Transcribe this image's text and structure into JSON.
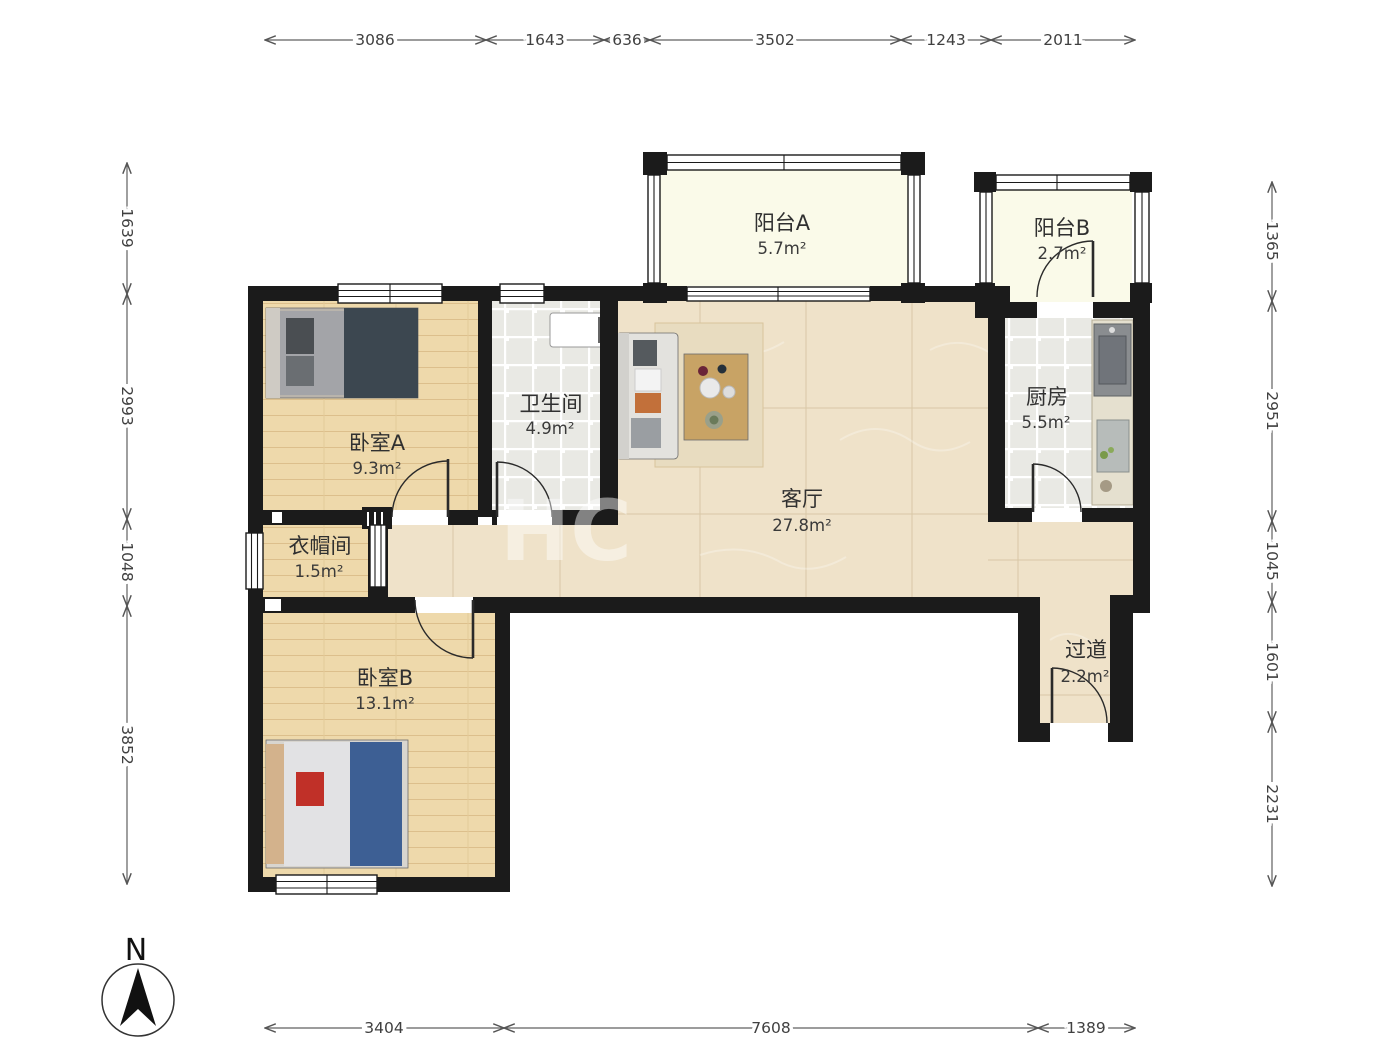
{
  "rooms": [
    {
      "id": "balcony-a",
      "name": "阳台A",
      "area": "5.7m²"
    },
    {
      "id": "balcony-b",
      "name": "阳台B",
      "area": "2.7m²"
    },
    {
      "id": "bedroom-a",
      "name": "卧室A",
      "area": "9.3m²"
    },
    {
      "id": "bathroom",
      "name": "卫生间",
      "area": "4.9m²"
    },
    {
      "id": "kitchen",
      "name": "厨房",
      "area": "5.5m²"
    },
    {
      "id": "living-room",
      "name": "客厅",
      "area": "27.8m²"
    },
    {
      "id": "cloakroom",
      "name": "衣帽间",
      "area": "1.5m²"
    },
    {
      "id": "bedroom-b",
      "name": "卧室B",
      "area": "13.1m²"
    },
    {
      "id": "hallway",
      "name": "过道",
      "area": "2.2m²"
    }
  ],
  "dimensions": {
    "top": [
      "3086",
      "1643",
      "636",
      "3502",
      "1243",
      "2011"
    ],
    "bottom": [
      "3404",
      "7608",
      "1389"
    ],
    "left": [
      "1639",
      "2993",
      "1048",
      "3852"
    ],
    "right": [
      "1365",
      "2951",
      "1045",
      "1601",
      "2231"
    ]
  },
  "compass": {
    "label": "N"
  },
  "watermark": "HC",
  "colors": {
    "wall": "#1b1b1b",
    "wood": "#eed9ab",
    "marble": "#efe2c9",
    "tile": "#e9e9e4",
    "balcony": "#fafae9"
  }
}
